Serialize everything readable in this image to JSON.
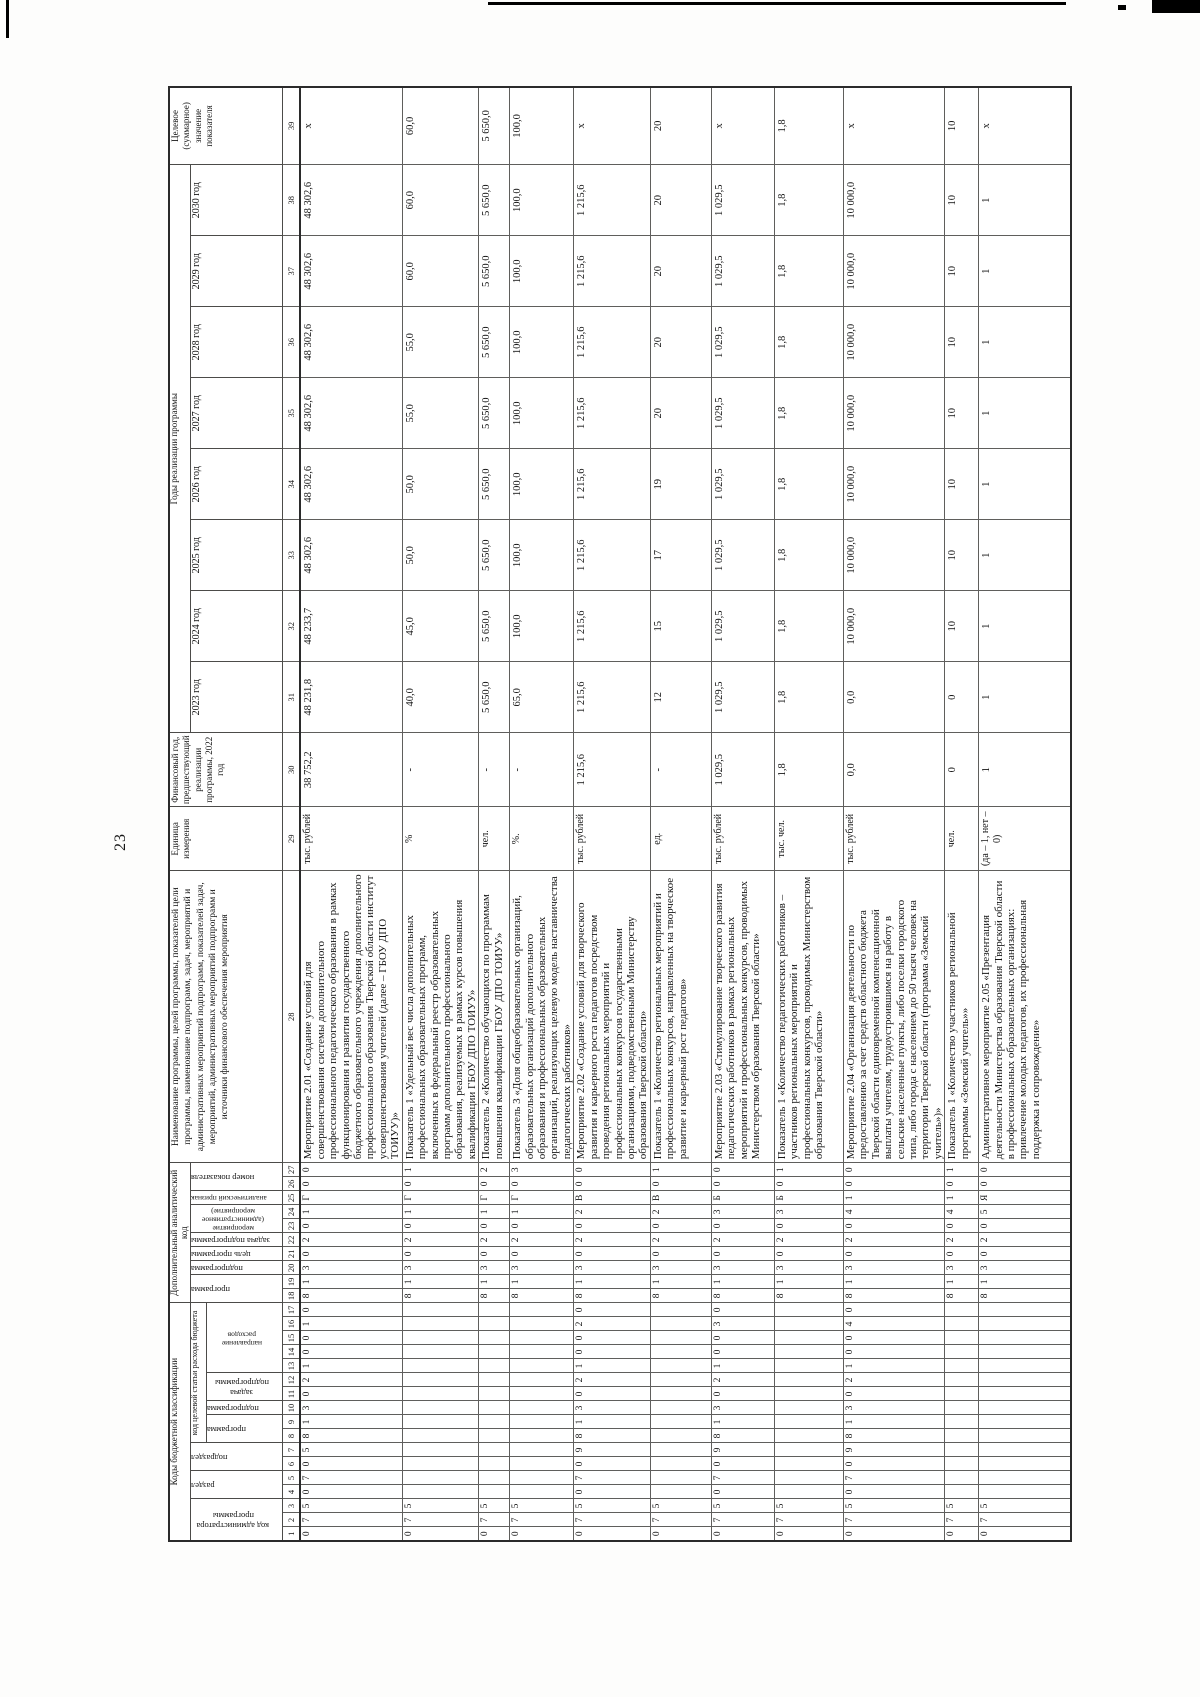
{
  "page": {
    "number": "23"
  },
  "table": {
    "header": {
      "codes_banner": "Коды бюджетной классификации",
      "admin_code": "код администратора программы",
      "razdel": "раздел",
      "podrazdel": "подраздел",
      "target_article": "код целевой статьи расхода бюджета",
      "ta_programma": "программа",
      "ta_podprogramma": "подпрограмма",
      "ta_zadacha": "задача подпрограммы",
      "ta_napravlenie": "направление расходов",
      "analytic_banner": "Дополнительный аналитический код",
      "an_programma": "программа",
      "an_podprogramma": "подпрограмма",
      "an_tsel": "цель программы",
      "an_zadacha": "задача подпрограммы",
      "an_meropriyatie": "мероприятие (административное мероприятие) подпрограммы",
      "an_priznak": "аналитический признак",
      "an_nomer": "номер показателя",
      "name_header": "Наименование программы, целей программы, показателей цели программы, наименование подпрограмм, задач, мероприятий и административных мероприятий подпрограмм, показателей задач, мероприятий, административных мероприятий подпрограмм и источники финансового обеспечения мероприятия",
      "unit": "Единица измерения",
      "fin_year": "Финансовый год, предшествующий реализации программы, 2022 год",
      "years_banner": "Годы реализации программы",
      "years": [
        "2023 год",
        "2024 год",
        "2025 год",
        "2026 год",
        "2027 год",
        "2028 год",
        "2029 год",
        "2030 год"
      ],
      "target_value": "Целевое (суммарное) значение показателя",
      "col_numbers": [
        "1",
        "2",
        "3",
        "4",
        "5",
        "6",
        "7",
        "8",
        "9",
        "10",
        "11",
        "12",
        "13",
        "14",
        "15",
        "16",
        "17",
        "18",
        "19",
        "20",
        "21",
        "22",
        "23",
        "24",
        "25",
        "26",
        "27",
        "28",
        "29",
        "30",
        "31",
        "32",
        "33",
        "34",
        "35",
        "36",
        "37",
        "38",
        "39"
      ]
    },
    "rows": [
      {
        "codes": [
          "0",
          "7",
          "5",
          "0",
          "7",
          "0",
          "5",
          "8",
          "1",
          "3",
          "0",
          "2",
          "1",
          "0",
          "0",
          "1",
          "0",
          "8",
          "1",
          "3",
          "0",
          "2",
          "0",
          "1",
          "Г",
          "0",
          "0"
        ],
        "name": "Мероприятие 2.01 «Создание условий для совершенствования системы дополнительного профессионального педагогического образования в рамках функционирования и развития государственного бюджетного образовательного учреждения дополнительного профессионального образования Тверской области институт усовершенствования учителей (далее – ГБОУ ДПО ТОИУУ)»",
        "unit": "тыс. рублей",
        "values": [
          "38 752,2",
          "48 231,8",
          "48 233,7",
          "48 302,6",
          "48 302,6",
          "48 302,6",
          "48 302,6",
          "48 302,6",
          "48 302,6"
        ],
        "target": "x"
      },
      {
        "codes": [
          "0",
          "7",
          "5",
          "",
          "",
          "",
          "",
          "",
          "",
          "",
          "",
          "",
          "",
          "",
          "",
          "",
          "",
          "8",
          "1",
          "3",
          "0",
          "2",
          "0",
          "1",
          "Г",
          "0",
          "1"
        ],
        "name": "Показатель 1 «Удельный вес числа дополнительных профессиональных образовательных программ, включенных в федеральный реестр образовательных программ дополнительного профессионального образования, реализуемых в рамках курсов повышения квалификации ГБОУ ДПО ТОИУУ»",
        "unit": "%",
        "values": [
          "-",
          "40,0",
          "45,0",
          "50,0",
          "50,0",
          "55,0",
          "55,0",
          "60,0",
          "60,0"
        ],
        "target": "60,0"
      },
      {
        "codes": [
          "0",
          "7",
          "5",
          "",
          "",
          "",
          "",
          "",
          "",
          "",
          "",
          "",
          "",
          "",
          "",
          "",
          "",
          "8",
          "1",
          "3",
          "0",
          "2",
          "0",
          "1",
          "Г",
          "0",
          "2"
        ],
        "name": "Показатель 2 «Количество обучающихся по программам повышения квалификации ГБОУ ДПО ТОИУУ»",
        "unit": "чел.",
        "values": [
          "-",
          "5 650,0",
          "5 650,0",
          "5 650,0",
          "5 650,0",
          "5 650,0",
          "5 650,0",
          "5 650,0",
          "5 650,0"
        ],
        "target": "5 650,0"
      },
      {
        "codes": [
          "0",
          "7",
          "5",
          "",
          "",
          "",
          "",
          "",
          "",
          "",
          "",
          "",
          "",
          "",
          "",
          "",
          "",
          "8",
          "1",
          "3",
          "0",
          "2",
          "0",
          "1",
          "Г",
          "0",
          "3"
        ],
        "name": "Показатель 3 «Доля общеобразовательных организаций, образовательных организаций дополнительного образования и профессиональных образовательных организаций, реализующих целевую модель наставничества педагогических работников»",
        "unit": "%.",
        "values": [
          "-",
          "65,0",
          "100,0",
          "100,0",
          "100,0",
          "100,0",
          "100,0",
          "100,0",
          "100,0"
        ],
        "target": "100,0"
      },
      {
        "codes": [
          "0",
          "7",
          "5",
          "0",
          "7",
          "0",
          "9",
          "8",
          "1",
          "3",
          "0",
          "2",
          "1",
          "0",
          "0",
          "2",
          "0",
          "8",
          "1",
          "3",
          "0",
          "2",
          "0",
          "2",
          "В",
          "0",
          "0"
        ],
        "name": "Мероприятие 2.02 «Создание условий для творческого развития и карьерного роста педагогов посредством проведения региональных мероприятий и профессиональных конкурсов государственными организациями, подведомственными Министерству образования Тверской области»",
        "unit": "тыс. рублей",
        "values": [
          "1 215,6",
          "1 215,6",
          "1 215,6",
          "1 215,6",
          "1 215,6",
          "1 215,6",
          "1 215,6",
          "1 215,6",
          "1 215,6"
        ],
        "target": "x"
      },
      {
        "codes": [
          "0",
          "7",
          "5",
          "",
          "",
          "",
          "",
          "",
          "",
          "",
          "",
          "",
          "",
          "",
          "",
          "",
          "",
          "8",
          "1",
          "3",
          "0",
          "2",
          "0",
          "2",
          "В",
          "0",
          "1"
        ],
        "name": "Показатель 1 «Количество региональных мероприятий и профессиональных конкурсов, направленных на творческое развитие и карьерный рост педагогов»",
        "unit": "ед.",
        "values": [
          "-",
          "12",
          "15",
          "17",
          "19",
          "20",
          "20",
          "20",
          "20"
        ],
        "target": "20"
      },
      {
        "codes": [
          "0",
          "7",
          "5",
          "0",
          "7",
          "0",
          "9",
          "8",
          "1",
          "3",
          "0",
          "2",
          "1",
          "0",
          "0",
          "3",
          "0",
          "8",
          "1",
          "3",
          "0",
          "2",
          "0",
          "3",
          "Б",
          "0",
          "0"
        ],
        "name": "Мероприятие 2.03 «Стимулирование творческого развития педагогических работников в рамках региональных мероприятий и профессиональных конкурсов, проводимых Министерством образования Тверской области»",
        "unit": "тыс. рублей",
        "values": [
          "1 029,5",
          "1 029,5",
          "1 029,5",
          "1 029,5",
          "1 029,5",
          "1 029,5",
          "1 029,5",
          "1 029,5",
          "1 029,5"
        ],
        "target": "x"
      },
      {
        "codes": [
          "0",
          "7",
          "5",
          "",
          "",
          "",
          "",
          "",
          "",
          "",
          "",
          "",
          "",
          "",
          "",
          "",
          "",
          "8",
          "1",
          "3",
          "0",
          "2",
          "0",
          "3",
          "Б",
          "0",
          "1"
        ],
        "name": "Показатель 1 «Количество педагогических работников – участников региональных мероприятий и профессиональных конкурсов, проводимых Министерством образования Тверской области»",
        "unit": "тыс. чел.",
        "values": [
          "1,8",
          "1,8",
          "1,8",
          "1,8",
          "1,8",
          "1,8",
          "1,8",
          "1,8",
          "1,8"
        ],
        "target": "1,8"
      },
      {
        "codes": [
          "0",
          "7",
          "5",
          "0",
          "7",
          "0",
          "9",
          "8",
          "1",
          "3",
          "0",
          "2",
          "1",
          "0",
          "0",
          "4",
          "0",
          "8",
          "1",
          "3",
          "0",
          "2",
          "0",
          "4",
          "1",
          "0",
          "0"
        ],
        "name": "Мероприятие 2.04 «Организация деятельности по предоставлению за счет средств областного бюджета Тверской области единовременной компенсационной выплаты учителям, трудоустроившимся на работу в сельские населенные пункты, либо поселки городского типа, либо города с населением до 50 тысяч человек на территории Тверской области (программа «Земский учитель»)»",
        "unit": "тыс. рублей",
        "values": [
          "0,0",
          "0,0",
          "10 000,0",
          "10 000,0",
          "10 000,0",
          "10 000,0",
          "10 000,0",
          "10 000,0",
          "10 000,0"
        ],
        "target": "x"
      },
      {
        "codes": [
          "0",
          "7",
          "5",
          "",
          "",
          "",
          "",
          "",
          "",
          "",
          "",
          "",
          "",
          "",
          "",
          "",
          "",
          "8",
          "1",
          "3",
          "0",
          "2",
          "0",
          "4",
          "1",
          "0",
          "1"
        ],
        "name": "Показатель 1 «Количество участников региональной программы «Земский учитель»»",
        "unit": "чел.",
        "values": [
          "0",
          "0",
          "10",
          "10",
          "10",
          "10",
          "10",
          "10",
          "10"
        ],
        "target": "10"
      },
      {
        "codes": [
          "0",
          "7",
          "5",
          "",
          "",
          "",
          "",
          "",
          "",
          "",
          "",
          "",
          "",
          "",
          "",
          "",
          "",
          "8",
          "1",
          "3",
          "0",
          "2",
          "0",
          "5",
          "Я",
          "0",
          "0"
        ],
        "name": "Административное мероприятие 2.05 «Презентация деятельности Министерства образования Тверской области в профессиональных образовательных организациях: привлечение молодых педагогов, их профессиональная поддержка и сопровождение»",
        "unit": "(да – 1, нет – 0)",
        "values": [
          "1",
          "1",
          "1",
          "1",
          "1",
          "1",
          "1",
          "1",
          "1"
        ],
        "target": "x"
      }
    ]
  }
}
